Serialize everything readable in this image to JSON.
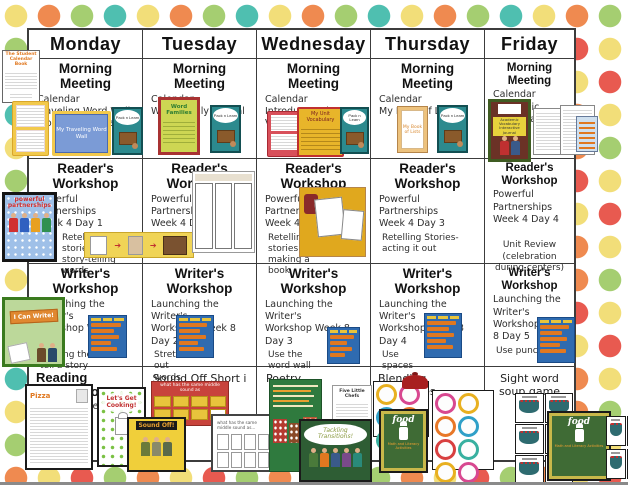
{
  "header": {
    "days": [
      "Monday",
      "Tuesday",
      "Wednesday",
      "Thursday",
      "Friday"
    ]
  },
  "morning": {
    "heading": "Morning Meeting",
    "cells": [
      {
        "lines": [
          "Calendar",
          "Traveling Word Wall",
          "Words of the Week"
        ]
      },
      {
        "lines": [
          "Calendar",
          "Word Family Journal",
          ""
        ]
      },
      {
        "lines": [
          "Calendar",
          "Introduce Unit",
          "Vocabulary"
        ]
      },
      {
        "lines": [
          "Calendar",
          "My Book of Lists",
          ""
        ]
      },
      {
        "lines": [
          "Calendar",
          "Academic Vocabulary",
          ""
        ]
      }
    ]
  },
  "reader": {
    "heading": "Reader's Workshop",
    "subheading": "Powerful Partnerships",
    "cells": [
      {
        "week": "Week 4 Day 1",
        "note": "Retelling stories-story-telling words"
      },
      {
        "week": "Week 4 Day 2a",
        "note": "Retelling stories using props"
      },
      {
        "week": "Week 4 Day 2b",
        "note": "Retelling stories making a book"
      },
      {
        "week": "Week 4 Day 3",
        "note": "Retelling Stories-acting it out"
      },
      {
        "week": "Week 4 Day 4",
        "note": "Unit Review (celebration during centers)"
      }
    ]
  },
  "writer": {
    "heading": "Writer's Workshop",
    "subheading": "Launching the Writer's",
    "cells": [
      {
        "week": "Workshop Week 8 Day 1",
        "note": "Helping the Reader tell a story"
      },
      {
        "week": "Workshop Week 8 Day 2",
        "note": "Stretch out words"
      },
      {
        "week": "Workshop Week 8 Day 3",
        "note": "Use the word wall"
      },
      {
        "week": "Workshop Week 8 Day 4",
        "note": "Use spaces"
      },
      {
        "week": "Workshop Week 8 Day 5",
        "note": "Use punctuation"
      }
    ]
  },
  "foundations": {
    "cells": [
      {
        "heading": "Reading Foundations",
        "sub": "How to Make Pizza"
      },
      {
        "heading": "Sound Off Short i"
      },
      {
        "heading": "Poetry"
      },
      {
        "heading": "Blending phonemes"
      },
      {
        "heading": "Sight word soup game"
      }
    ]
  },
  "thumbs": {
    "student_calendar_book": "The Student Calendar Book",
    "traveling_word_wall": "My Traveling Word Wall",
    "pack_n_learn": "Pack n Learn",
    "word_families": "Word Families",
    "unit_vocabulary": "My Unit Vocabulary",
    "book_of_lists": "My Book of Lists",
    "academic_vocabulary_journal": "Academic Vocabulary Interactive Journal",
    "powerful_partnerships": "powerful partnerships",
    "i_can_write": "I Can Write!",
    "pizza_worksheet": "Pizza",
    "lets_get_cooking": "Let's Get Cooking!",
    "middle_sound_chart": "what has the same middle sound as",
    "sound_off": "Sound Off!",
    "middle_sound_worksheet": "what has the same middle sound as...",
    "five_little_chefs": "Five Little Chefs",
    "tackling_transitions": "Tackling Transitions!",
    "food_title": "food",
    "food_sub": "Math and Literacy Activities"
  },
  "colors": {
    "dot_yellow": "#F2DE79",
    "dot_orange": "#EF8A50",
    "dot_green": "#A5CE71",
    "dot_teal": "#4FBFB0",
    "dot_red": "#E85A50",
    "table_border": "#3C3C3C"
  }
}
